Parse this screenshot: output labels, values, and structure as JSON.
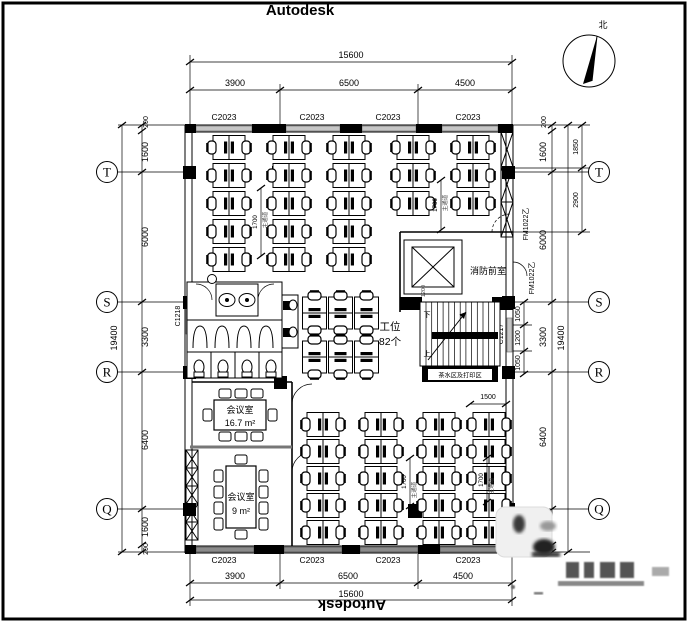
{
  "sheet": {
    "brand_top": "Autodesk",
    "brand_bottom": "Autodesk"
  },
  "north_label": "北",
  "grid_axes": {
    "t": "T",
    "s": "S",
    "r": "R",
    "q": "Q"
  },
  "dims": {
    "top": {
      "overall": "15600",
      "seg1": "3900",
      "seg2": "6500",
      "seg3": "4500"
    },
    "bottom": {
      "overall": "15600",
      "seg1": "3900",
      "seg2": "6500",
      "seg3": "4500"
    },
    "left": {
      "overall": "19400",
      "segs": [
        "200",
        "1600",
        "6000",
        "3300",
        "6400",
        "1600",
        "200"
      ]
    },
    "right": {
      "overall": "19400",
      "segs": [
        "200",
        "1600",
        "6000",
        "3300",
        "6400",
        "1600",
        "200"
      ],
      "inner": [
        "1850",
        "2900"
      ],
      "stair": [
        "1050",
        "1200",
        "1050"
      ]
    }
  },
  "windows": {
    "top": [
      "C2023",
      "C2023",
      "C2023",
      "C2023"
    ],
    "bottom": [
      "C2023",
      "C2023",
      "C2023",
      "C2023"
    ],
    "left": "C1218",
    "stair": "C1217"
  },
  "doors": {
    "fm1": "FM1022乙",
    "fm2": "FM1022乙"
  },
  "rooms": {
    "fire_lobby": "消防前室",
    "workstation_label": "工位",
    "workstation_count": "82个",
    "meeting_large_name": "会议室",
    "meeting_large_area": "16.7 m²",
    "meeting_small_name": "会议室",
    "meeting_small_area": "9 m²",
    "pantry": "茶水区及打印区",
    "stair_down": "下",
    "stair_up": "上"
  },
  "annotations": {
    "aisle_upper_left": {
      "value": "1700",
      "label": "主通道"
    },
    "aisle_upper_right": {
      "value": "1700",
      "label": "主通道"
    },
    "aisle_lower_left": {
      "value": "1700",
      "label": "主通道"
    },
    "aisle_lower_right": {
      "value": "1700",
      "label": "主通道"
    },
    "desk_depth": "1500",
    "stair_flight": "1200"
  }
}
